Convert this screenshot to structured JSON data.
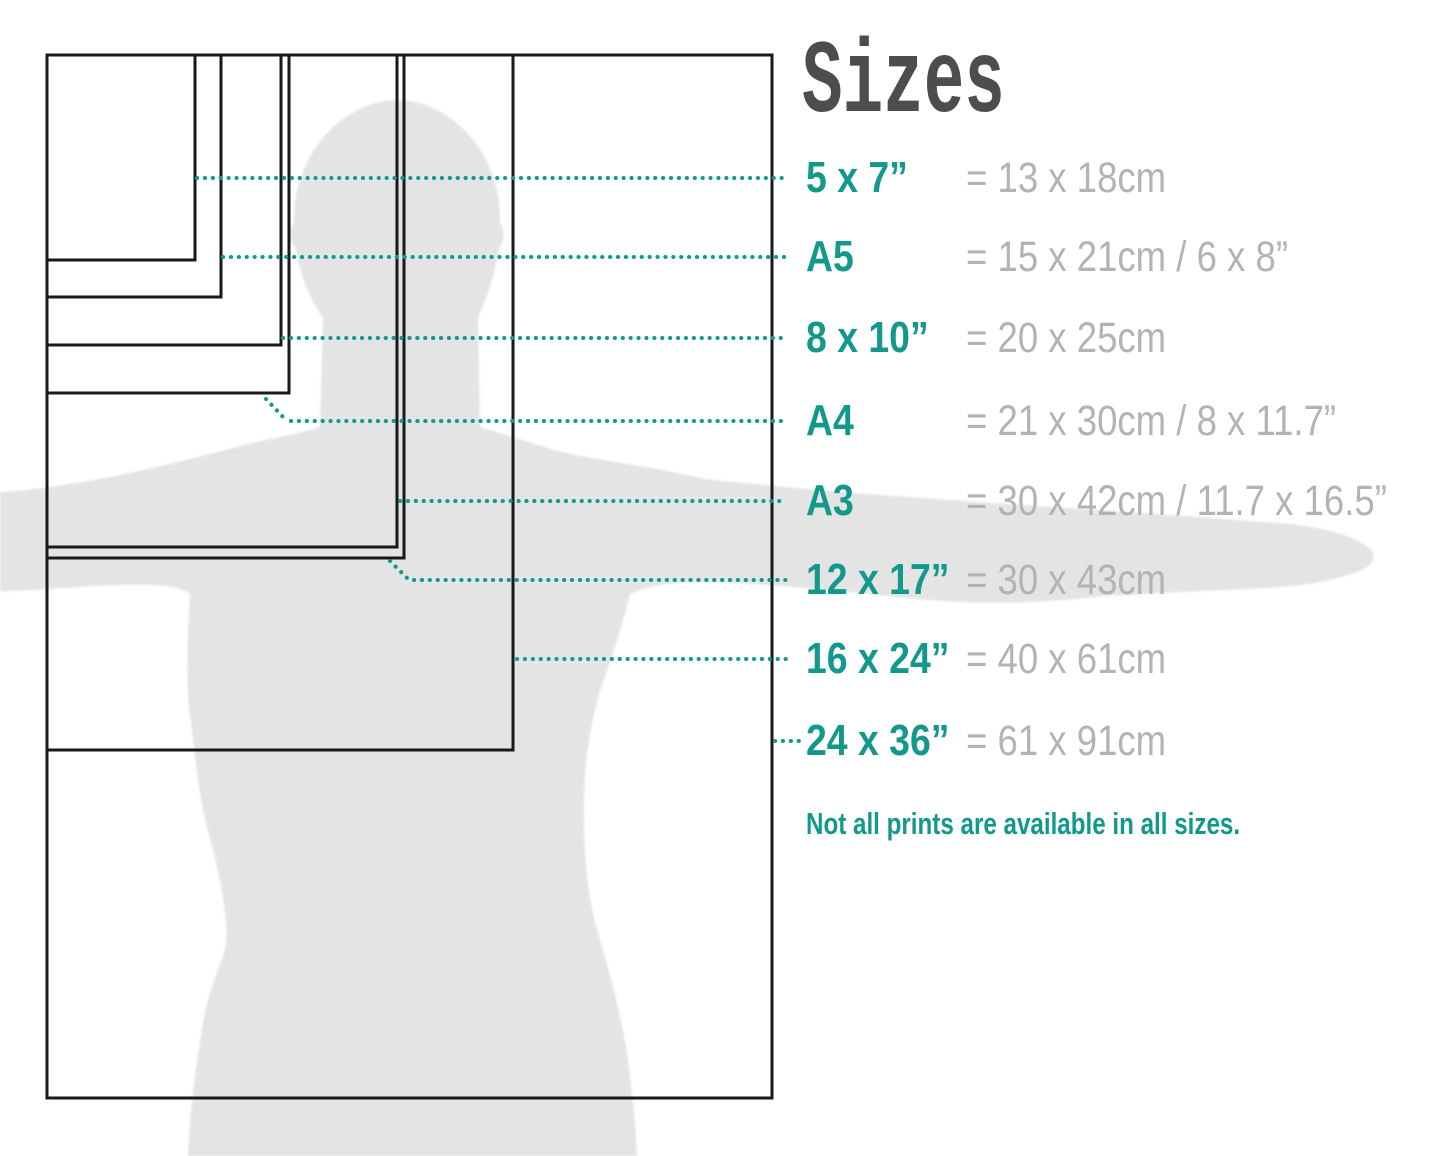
{
  "title": "Sizes",
  "note": "Not all prints are available in all sizes.",
  "rows": [
    {
      "label": "5 x 7”",
      "metric": "= 13 x 18cm"
    },
    {
      "label": "A5",
      "metric": "= 15 x 21cm / 6 x 8”"
    },
    {
      "label": "8 x 10”",
      "metric": "= 20 x 25cm"
    },
    {
      "label": "A4",
      "metric": "= 21 x 30cm / 8 x 11.7”"
    },
    {
      "label": "A3",
      "metric": "= 30 x 42cm / 11.7 x 16.5”"
    },
    {
      "label": "12 x 17”",
      "metric": "= 30 x 43cm"
    },
    {
      "label": "16 x 24”",
      "metric": "= 40 x 61cm"
    },
    {
      "label": "24 x 36”",
      "metric": "= 61 x 91cm"
    }
  ],
  "colors": {
    "teal": "#12998c",
    "metric_gray": "#b3b3b3",
    "title_gray": "#4c4d4f",
    "silhouette_gray": "#e4e4e4",
    "outline_black": "#191919",
    "background": "#ffffff"
  }
}
